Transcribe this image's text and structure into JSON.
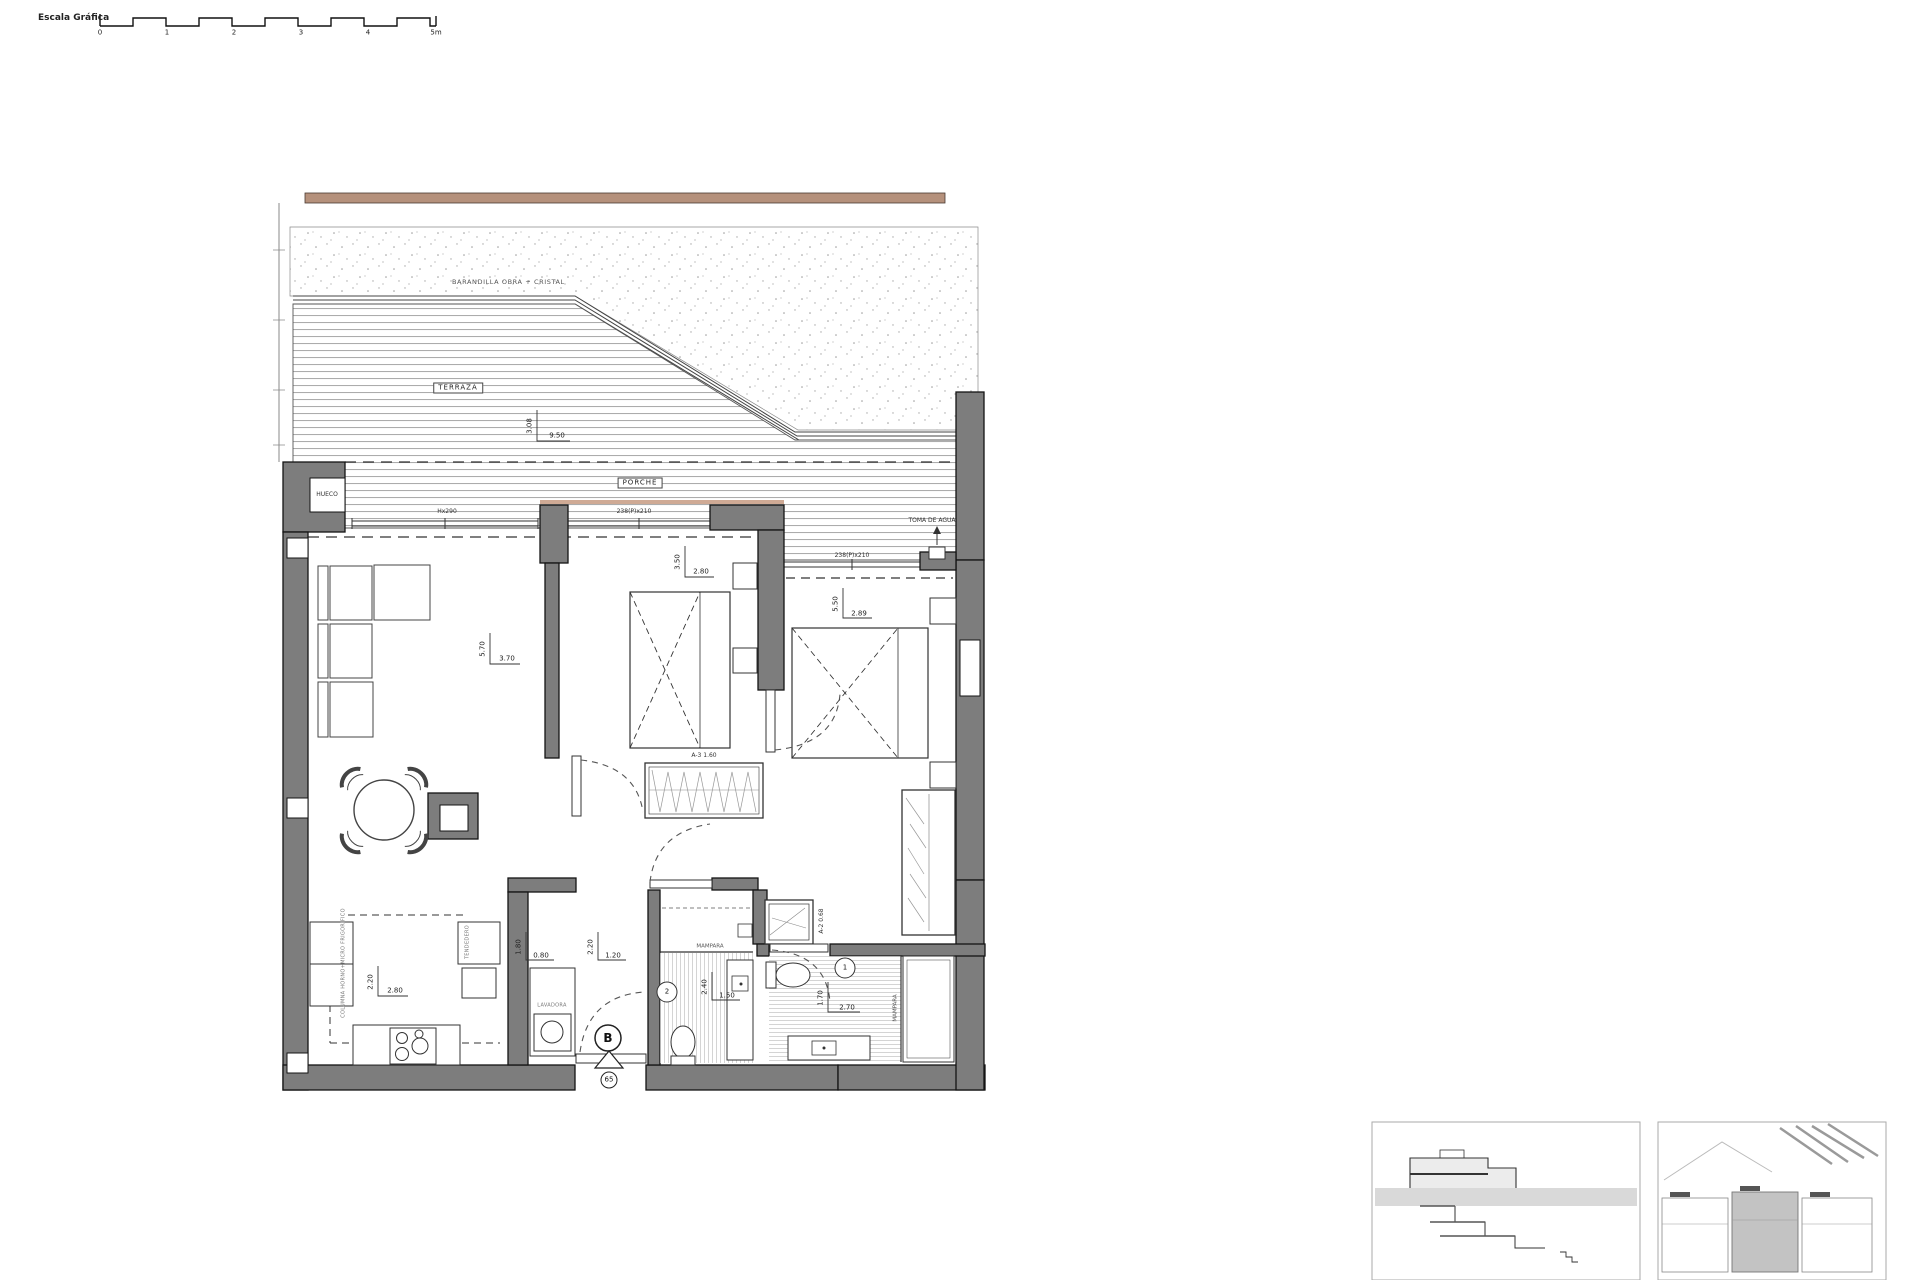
{
  "scale_bar": {
    "label": "Escala Gráfica",
    "ticks": [
      "0",
      "1",
      "2",
      "3",
      "4",
      "5m"
    ]
  },
  "plan": {
    "labels": {
      "railing": "BARANDILLA OBRA + CRISTAL",
      "terrace": "TERRAZA",
      "porch": "PORCHE",
      "hueco": "HUECO",
      "water_intake": "TOMA DE AGUA",
      "window_living": "Hx290",
      "window_bed1": "238(P)x210",
      "window_bed2": "238(P)x210",
      "closet_a3": "A-3 1.60",
      "closet_a2": "A-2 0.68",
      "mampara_bath2": "MAMPARA",
      "mampara_bath1": "MAMPARA",
      "kitchen_column": "COLUMNA HORNO+MICRO FRIGORIFICO",
      "kitchen_right": "TENDEDERO",
      "washer": "LAVADORA"
    },
    "dims": {
      "terrace": {
        "v": "3.08",
        "h": "9.50"
      },
      "living": {
        "v": "5.70",
        "h": "3.70"
      },
      "bed1": {
        "v": "3.50",
        "h": "2.80"
      },
      "bed2": {
        "v": "5.50",
        "h": "2.89"
      },
      "kitchen": {
        "v": "2.20",
        "h": "2.80"
      },
      "laundry": {
        "v": "1.80",
        "h": "0.80"
      },
      "hall": {
        "v": "2.20",
        "h": "1.20"
      },
      "bath2": {
        "v": "2.40",
        "h": "1.50"
      },
      "bath1": {
        "v": "1.70",
        "h": "2.70"
      }
    },
    "markers": {
      "entrance_letter": "B",
      "entrance_number": "65",
      "bath1": "1",
      "bath2": "2"
    },
    "colors": {
      "wall": "#7d7d7d",
      "coping": "#b5917c",
      "line": "#333333"
    }
  }
}
